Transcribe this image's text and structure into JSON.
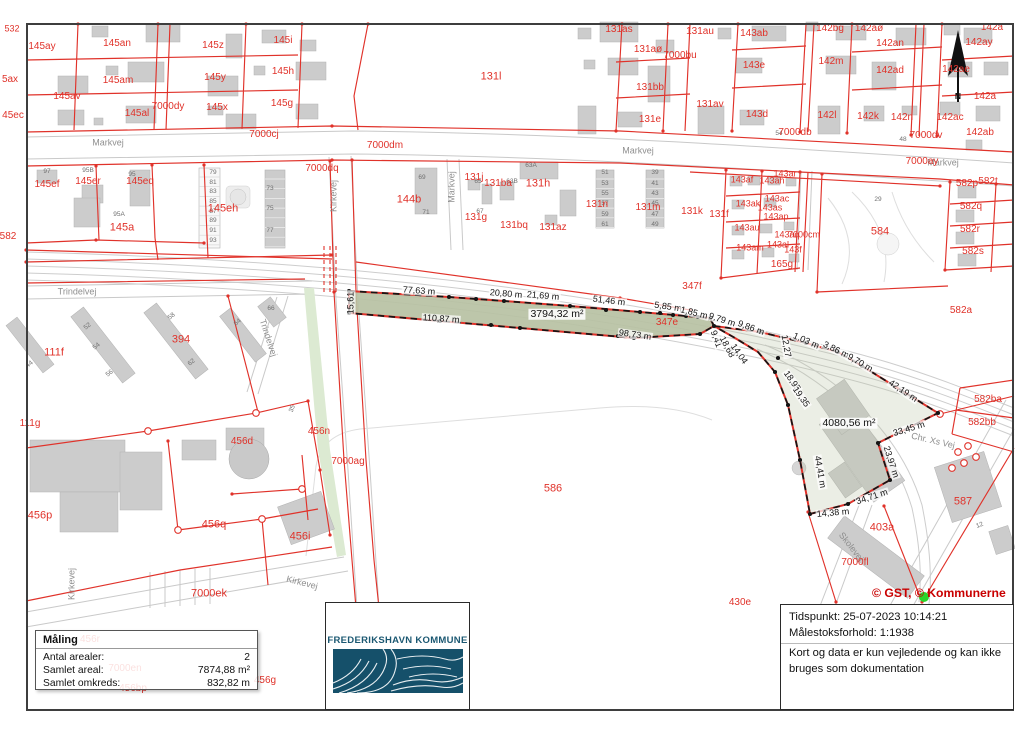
{
  "map": {
    "colors": {
      "parcel_red": "#e0322a",
      "measured_fill_green": "#b7c1a3",
      "roadside_strip_green": "#dcead2",
      "road_gray": "#c9c9c9",
      "building_gray": "#cccccc",
      "logo_teal": "#1b5872",
      "copyright_red": "#c90000",
      "marker_green": "#2bd62b"
    },
    "copyright": {
      "t": "© GST, © Kommunerne",
      "x": 872,
      "y": 586
    },
    "north": {
      "t": "N",
      "x": 958,
      "y": 96
    },
    "area_labels": [
      {
        "t": "3794,32 m²",
        "x": 557,
        "y": 314
      },
      {
        "t": "4080,56 m²",
        "x": 849,
        "y": 423
      }
    ],
    "measurements": [
      {
        "t": "77,63 m",
        "x": 419,
        "y": 291,
        "rot": 4
      },
      {
        "t": "20,80 m",
        "x": 506,
        "y": 294,
        "rot": 5
      },
      {
        "t": "21,69 m",
        "x": 543,
        "y": 296,
        "rot": 5
      },
      {
        "t": "51,46 m",
        "x": 609,
        "y": 301,
        "rot": 7
      },
      {
        "t": "5,85 m",
        "x": 668,
        "y": 307,
        "rot": 8
      },
      {
        "t": "1,85 m",
        "x": 694,
        "y": 313,
        "rot": 14
      },
      {
        "t": "9,79 m",
        "x": 722,
        "y": 320,
        "rot": 18
      },
      {
        "t": "9,86 m",
        "x": 751,
        "y": 328,
        "rot": 20
      },
      {
        "t": "1,03 m",
        "x": 806,
        "y": 341,
        "rot": 24
      },
      {
        "t": "3,86 m",
        "x": 836,
        "y": 350,
        "rot": 26
      },
      {
        "t": "9,70 m",
        "x": 860,
        "y": 363,
        "rot": 30
      },
      {
        "t": "42,19 m",
        "x": 903,
        "y": 391,
        "rot": 34
      },
      {
        "t": "110,87 m",
        "x": 441,
        "y": 319,
        "rot": 4
      },
      {
        "t": "98,73 m",
        "x": 635,
        "y": 335,
        "rot": 8
      },
      {
        "t": "15,61",
        "x": 351,
        "y": 303,
        "rot": -90
      },
      {
        "t": "9,41",
        "x": 716,
        "y": 339,
        "rot": 70
      },
      {
        "t": "18,68",
        "x": 727,
        "y": 347,
        "rot": 62
      },
      {
        "t": "14,04",
        "x": 739,
        "y": 354,
        "rot": 55
      },
      {
        "t": "12,27",
        "x": 786,
        "y": 346,
        "rot": 80
      },
      {
        "t": "18,95",
        "x": 792,
        "y": 381,
        "rot": 55
      },
      {
        "t": "19,35",
        "x": 801,
        "y": 397,
        "rot": 55
      },
      {
        "t": "44,41 m",
        "x": 820,
        "y": 472,
        "rot": 80
      },
      {
        "t": "33,45 m",
        "x": 909,
        "y": 429,
        "rot": -17
      },
      {
        "t": "23,97 m",
        "x": 891,
        "y": 462,
        "rot": 72
      },
      {
        "t": "34,71 m",
        "x": 872,
        "y": 497,
        "rot": -18
      },
      {
        "t": "14,38 m",
        "x": 833,
        "y": 513,
        "rot": -5
      }
    ],
    "parcel_labels": [
      {
        "t": "532",
        "x": 12,
        "y": 29,
        "fs": 9
      },
      {
        "t": "145ay",
        "x": 42,
        "y": 47
      },
      {
        "t": "145an",
        "x": 117,
        "y": 44
      },
      {
        "t": "145z",
        "x": 213,
        "y": 46
      },
      {
        "t": "145i",
        "x": 283,
        "y": 41
      },
      {
        "t": "5ax",
        "x": 10,
        "y": 80
      },
      {
        "t": "145am",
        "x": 118,
        "y": 81
      },
      {
        "t": "145y",
        "x": 215,
        "y": 78
      },
      {
        "t": "145h",
        "x": 283,
        "y": 72
      },
      {
        "t": "145av",
        "x": 67,
        "y": 97
      },
      {
        "t": "45ec",
        "x": 13,
        "y": 116
      },
      {
        "t": "145al",
        "x": 137,
        "y": 114
      },
      {
        "t": "7000dy",
        "x": 168,
        "y": 107
      },
      {
        "t": "145x",
        "x": 217,
        "y": 108
      },
      {
        "t": "145g",
        "x": 282,
        "y": 104
      },
      {
        "t": "7000cj",
        "x": 264,
        "y": 135
      },
      {
        "t": "145ef",
        "x": 47,
        "y": 185
      },
      {
        "t": "145er",
        "x": 88,
        "y": 182
      },
      {
        "t": "145eq",
        "x": 140,
        "y": 182
      },
      {
        "t": "145eh",
        "x": 223,
        "y": 209,
        "fs": 11
      },
      {
        "t": "145a",
        "x": 122,
        "y": 228,
        "fs": 11
      },
      {
        "t": "582",
        "x": 8,
        "y": 237
      },
      {
        "t": "131l",
        "x": 491,
        "y": 77,
        "fs": 11
      },
      {
        "t": "131as",
        "x": 619,
        "y": 30
      },
      {
        "t": "131aø",
        "x": 648,
        "y": 50
      },
      {
        "t": "7000bu",
        "x": 680,
        "y": 56
      },
      {
        "t": "131bb",
        "x": 650,
        "y": 88
      },
      {
        "t": "131e",
        "x": 650,
        "y": 120
      },
      {
        "t": "131au",
        "x": 700,
        "y": 32
      },
      {
        "t": "143ab",
        "x": 754,
        "y": 34
      },
      {
        "t": "142bg",
        "x": 830,
        "y": 29
      },
      {
        "t": "142aø",
        "x": 869,
        "y": 29
      },
      {
        "t": "142an",
        "x": 890,
        "y": 44
      },
      {
        "t": "142ay",
        "x": 979,
        "y": 43
      },
      {
        "t": "142a",
        "x": 992,
        "y": 28
      },
      {
        "t": "143e",
        "x": 754,
        "y": 66
      },
      {
        "t": "142m",
        "x": 831,
        "y": 62
      },
      {
        "t": "142ad",
        "x": 890,
        "y": 71
      },
      {
        "t": "142ae",
        "x": 956,
        "y": 70
      },
      {
        "t": "131av",
        "x": 710,
        "y": 105
      },
      {
        "t": "143d",
        "x": 757,
        "y": 115
      },
      {
        "t": "142l",
        "x": 827,
        "y": 116
      },
      {
        "t": "142k",
        "x": 868,
        "y": 117
      },
      {
        "t": "142n",
        "x": 902,
        "y": 118
      },
      {
        "t": "142ac",
        "x": 950,
        "y": 118
      },
      {
        "t": "142a",
        "x": 985,
        "y": 97
      },
      {
        "t": "142ab",
        "x": 980,
        "y": 133
      },
      {
        "t": "7000dv",
        "x": 926,
        "y": 136
      },
      {
        "t": "7000db",
        "x": 795,
        "y": 133
      },
      {
        "t": "7000dm",
        "x": 385,
        "y": 146
      },
      {
        "t": "7000dq",
        "x": 322,
        "y": 169
      },
      {
        "t": "144b",
        "x": 409,
        "y": 200,
        "fs": 11
      },
      {
        "t": "131j",
        "x": 474,
        "y": 178
      },
      {
        "t": "131ba",
        "x": 498,
        "y": 184
      },
      {
        "t": "131h",
        "x": 538,
        "y": 184,
        "fs": 11
      },
      {
        "t": "131g",
        "x": 476,
        "y": 218
      },
      {
        "t": "131bq",
        "x": 514,
        "y": 226
      },
      {
        "t": "131az",
        "x": 553,
        "y": 228
      },
      {
        "t": "131n",
        "x": 597,
        "y": 205
      },
      {
        "t": "131m",
        "x": 648,
        "y": 208
      },
      {
        "t": "131k",
        "x": 692,
        "y": 212
      },
      {
        "t": "131f",
        "x": 719,
        "y": 215
      },
      {
        "t": "143ar",
        "x": 785,
        "y": 174,
        "fs": 9
      },
      {
        "t": "143af",
        "x": 742,
        "y": 180,
        "fs": 9
      },
      {
        "t": "143ah",
        "x": 772,
        "y": 181,
        "fs": 9
      },
      {
        "t": "143ak",
        "x": 748,
        "y": 204,
        "fs": 9
      },
      {
        "t": "143ac",
        "x": 777,
        "y": 199,
        "fs": 9
      },
      {
        "t": "143as",
        "x": 770,
        "y": 208,
        "fs": 9
      },
      {
        "t": "143ap",
        "x": 776,
        "y": 217,
        "fs": 9
      },
      {
        "t": "143au",
        "x": 747,
        "y": 228,
        "fs": 9
      },
      {
        "t": "143aq",
        "x": 787,
        "y": 235,
        "fs": 9
      },
      {
        "t": "7000cm",
        "x": 804,
        "y": 235,
        "fs": 9
      },
      {
        "t": "143am",
        "x": 750,
        "y": 248,
        "fs": 9
      },
      {
        "t": "143al",
        "x": 778,
        "y": 245,
        "fs": 9
      },
      {
        "t": "143f",
        "x": 793,
        "y": 250,
        "fs": 9
      },
      {
        "t": "165g",
        "x": 782,
        "y": 265
      },
      {
        "t": "584",
        "x": 880,
        "y": 232,
        "fs": 11
      },
      {
        "t": "582p",
        "x": 967,
        "y": 184
      },
      {
        "t": "582t",
        "x": 988,
        "y": 182
      },
      {
        "t": "582q",
        "x": 971,
        "y": 207
      },
      {
        "t": "582r",
        "x": 970,
        "y": 230
      },
      {
        "t": "582s",
        "x": 973,
        "y": 252
      },
      {
        "t": "347f",
        "x": 692,
        "y": 287
      },
      {
        "t": "347e",
        "x": 667,
        "y": 323
      },
      {
        "t": "582a",
        "x": 961,
        "y": 311
      },
      {
        "t": "7000ay",
        "x": 922,
        "y": 162
      },
      {
        "t": "111f",
        "x": 54,
        "y": 353,
        "fs": 11
      },
      {
        "t": "394",
        "x": 181,
        "y": 340,
        "fs": 11
      },
      {
        "t": "111g",
        "x": 30,
        "y": 424
      },
      {
        "t": "456n",
        "x": 319,
        "y": 432
      },
      {
        "t": "456d",
        "x": 242,
        "y": 442
      },
      {
        "t": "7000ag",
        "x": 348,
        "y": 462
      },
      {
        "t": "456p",
        "x": 40,
        "y": 516,
        "fs": 11
      },
      {
        "t": "456q",
        "x": 214,
        "y": 525,
        "fs": 11
      },
      {
        "t": "456i",
        "x": 300,
        "y": 537,
        "fs": 11
      },
      {
        "t": "7000ek",
        "x": 209,
        "y": 594,
        "fs": 11
      },
      {
        "t": "586",
        "x": 553,
        "y": 489,
        "fs": 11
      },
      {
        "t": "587",
        "x": 963,
        "y": 502,
        "fs": 11
      },
      {
        "t": "403a",
        "x": 882,
        "y": 528,
        "fs": 11
      },
      {
        "t": "7000fl",
        "x": 855,
        "y": 563
      },
      {
        "t": "582ba",
        "x": 988,
        "y": 400
      },
      {
        "t": "582bb",
        "x": 982,
        "y": 423
      },
      {
        "t": "430e",
        "x": 740,
        "y": 603
      },
      {
        "t": "456g",
        "x": 265,
        "y": 681
      },
      {
        "t": "456r",
        "x": 90,
        "y": 640
      },
      {
        "t": "7000en",
        "x": 125,
        "y": 669
      },
      {
        "t": "456bp",
        "x": 133,
        "y": 689
      }
    ],
    "street_labels": [
      {
        "t": "Markvej",
        "x": 108,
        "y": 143
      },
      {
        "t": "Markvej",
        "x": 638,
        "y": 151
      },
      {
        "t": "Markvej",
        "x": 943,
        "y": 163
      },
      {
        "t": "Markvej",
        "x": 452,
        "y": 187,
        "rot": -90
      },
      {
        "t": "Kirkevej",
        "x": 334,
        "y": 196,
        "rot": -90
      },
      {
        "t": "Trindelvej",
        "x": 77,
        "y": 292
      },
      {
        "t": "Trindelvej",
        "x": 268,
        "y": 338,
        "rot": 72
      },
      {
        "t": "Kirkevej",
        "x": 72,
        "y": 584,
        "rot": -90
      },
      {
        "t": "Kirkevej",
        "x": 302,
        "y": 583,
        "rot": 14
      },
      {
        "t": "Chr. Xs Vej",
        "x": 933,
        "y": 441,
        "rot": 13
      },
      {
        "t": "Skolevej",
        "x": 851,
        "y": 547,
        "rot": 52
      }
    ],
    "house_numbers": [
      {
        "t": "97",
        "x": 47,
        "y": 172
      },
      {
        "t": "95B",
        "x": 88,
        "y": 171
      },
      {
        "t": "95",
        "x": 132,
        "y": 175
      },
      {
        "t": "95A",
        "x": 119,
        "y": 215
      },
      {
        "t": "79",
        "x": 213,
        "y": 173
      },
      {
        "t": "81",
        "x": 213,
        "y": 183
      },
      {
        "t": "83",
        "x": 213,
        "y": 192
      },
      {
        "t": "85",
        "x": 213,
        "y": 202
      },
      {
        "t": "87",
        "x": 213,
        "y": 212
      },
      {
        "t": "89",
        "x": 213,
        "y": 221
      },
      {
        "t": "91",
        "x": 213,
        "y": 231
      },
      {
        "t": "93",
        "x": 213,
        "y": 241
      },
      {
        "t": "73",
        "x": 270,
        "y": 189
      },
      {
        "t": "75",
        "x": 270,
        "y": 209
      },
      {
        "t": "77",
        "x": 270,
        "y": 231
      },
      {
        "t": "69",
        "x": 422,
        "y": 178
      },
      {
        "t": "71",
        "x": 426,
        "y": 213
      },
      {
        "t": "65",
        "x": 478,
        "y": 182
      },
      {
        "t": "67",
        "x": 480,
        "y": 212
      },
      {
        "t": "63A",
        "x": 531,
        "y": 166
      },
      {
        "t": "63B",
        "x": 512,
        "y": 182
      },
      {
        "t": "51",
        "x": 605,
        "y": 173
      },
      {
        "t": "53",
        "x": 605,
        "y": 184
      },
      {
        "t": "55",
        "x": 605,
        "y": 194
      },
      {
        "t": "57",
        "x": 605,
        "y": 204
      },
      {
        "t": "59",
        "x": 605,
        "y": 215
      },
      {
        "t": "61",
        "x": 605,
        "y": 225
      },
      {
        "t": "39",
        "x": 655,
        "y": 173
      },
      {
        "t": "41",
        "x": 655,
        "y": 184
      },
      {
        "t": "43",
        "x": 655,
        "y": 194
      },
      {
        "t": "45",
        "x": 655,
        "y": 204
      },
      {
        "t": "47",
        "x": 655,
        "y": 215
      },
      {
        "t": "49",
        "x": 655,
        "y": 225
      },
      {
        "t": "48",
        "x": 903,
        "y": 140
      },
      {
        "t": "54",
        "x": 779,
        "y": 134
      },
      {
        "t": "29",
        "x": 878,
        "y": 200
      },
      {
        "t": "52",
        "x": 88,
        "y": 327,
        "rot": -38
      },
      {
        "t": "54",
        "x": 97,
        "y": 347,
        "rot": -38
      },
      {
        "t": "56",
        "x": 110,
        "y": 374,
        "rot": -38
      },
      {
        "t": "58",
        "x": 172,
        "y": 317,
        "rot": -38
      },
      {
        "t": "62",
        "x": 192,
        "y": 363,
        "rot": -38
      },
      {
        "t": "64",
        "x": 238,
        "y": 323,
        "rot": -38
      },
      {
        "t": "66",
        "x": 271,
        "y": 309
      },
      {
        "t": "35",
        "x": 293,
        "y": 409,
        "rot": -70
      },
      {
        "t": "44",
        "x": 30,
        "y": 365,
        "rot": -38
      },
      {
        "t": "12",
        "x": 980,
        "y": 526,
        "rot": -20
      }
    ]
  },
  "measure_box": {
    "title": "Måling",
    "rows": [
      {
        "label": "Antal arealer:",
        "value": "2"
      },
      {
        "label": "Samlet areal:",
        "value": "7874,88 m²"
      },
      {
        "label": "Samlet omkreds:",
        "value": "832,82 m"
      }
    ]
  },
  "logo": {
    "text": "FREDERIKSHAVN KOMMUNE"
  },
  "info_box": {
    "line1": "Tidspunkt: 25-07-2023 10:14:21",
    "line2": "Målestoksforhold: 1:1938",
    "disclaimer": "Kort og data er kun vejledende og kan ikke bruges som dokumentation"
  }
}
